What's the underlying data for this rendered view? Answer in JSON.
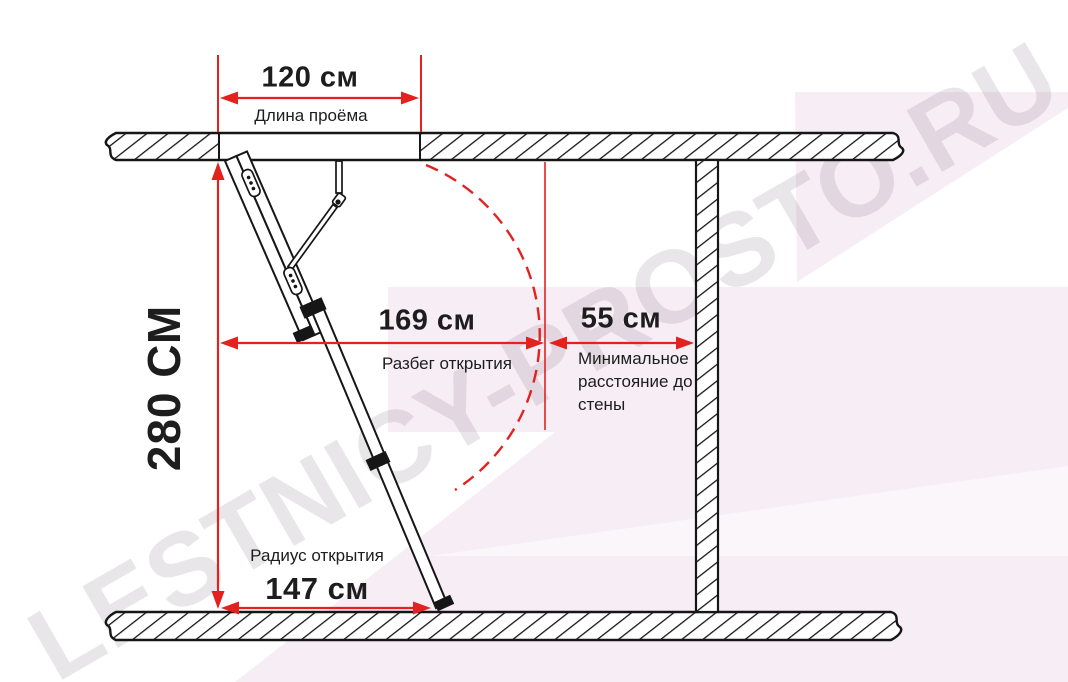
{
  "watermark": "LESTNICY-PROSTO.RU",
  "dimensions": {
    "opening_length": {
      "value": "120 см",
      "label": "Длина проёма"
    },
    "height": {
      "value": "280 СМ"
    },
    "opening_span": {
      "value": "169 см",
      "label": "Разбег открытия"
    },
    "min_wall_distance": {
      "value": "55 см",
      "label": "Минимальное расстояние до стены"
    },
    "opening_radius": {
      "value": "147 см",
      "label": "Радиус открытия"
    }
  },
  "colors": {
    "dimension_red": "#e3221f",
    "line_black": "#161616",
    "background_pink": "#f7edf5",
    "watermark_gray": "rgba(123,108,122,0.17)"
  }
}
